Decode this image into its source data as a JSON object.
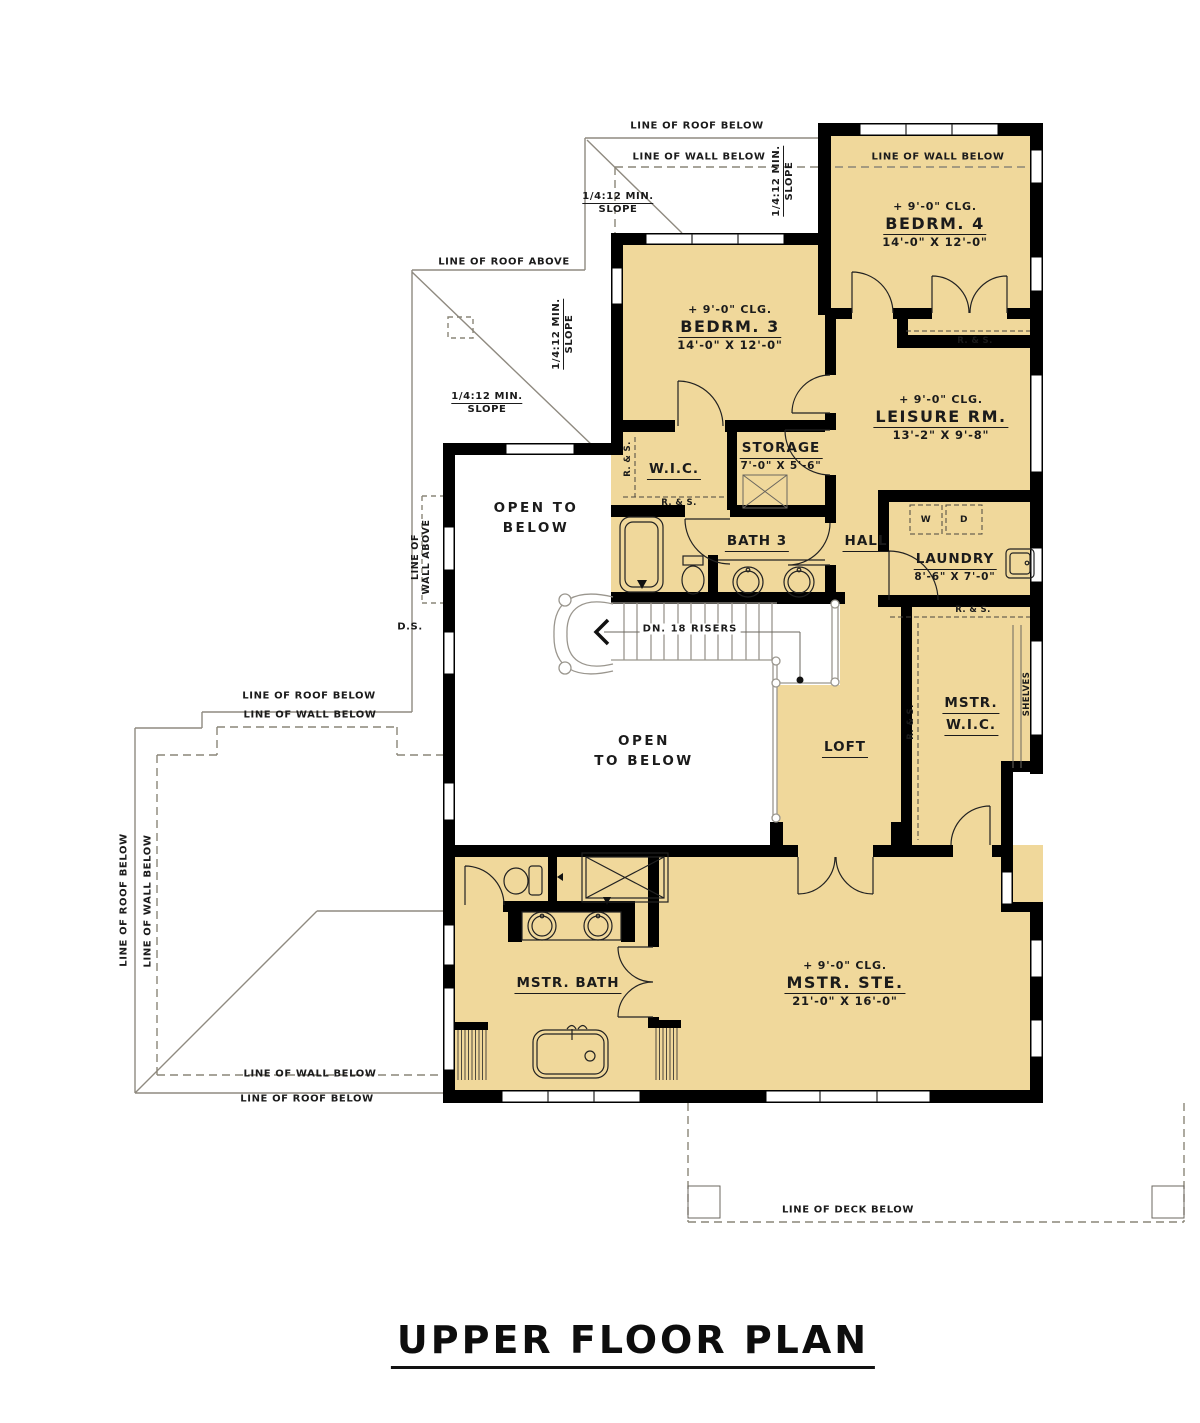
{
  "title": "UPPER FLOOR PLAN",
  "labels": {
    "roof_below": "LINE OF ROOF BELOW",
    "wall_below": "LINE OF WALL BELOW",
    "roof_above": "LINE OF ROOF ABOVE",
    "wall_above_1": "LINE OF",
    "wall_above_2": "WALL ABOVE",
    "deck_below": "LINE OF DECK BELOW",
    "slope_1": "1/4:12 MIN.",
    "slope_2": "SLOPE",
    "downspout": "D.S.",
    "stairs": "DN. 18 RISERS",
    "rod_shelf": "R. & S.",
    "shelves": "SHELVES",
    "washer": "W",
    "dryer": "D",
    "open_below_a1": "OPEN TO",
    "open_below_a2": "BELOW",
    "open_below_b1": "OPEN",
    "open_below_b2": "TO BELOW"
  },
  "rooms": {
    "bedrm4": {
      "ceiling": "+ 9'-0\" CLG.",
      "name": "BEDRM. 4",
      "dims": "14'-0\" X 12'-0\""
    },
    "bedrm3": {
      "ceiling": "+ 9'-0\" CLG.",
      "name": "BEDRM. 3",
      "dims": "14'-0\" X 12'-0\""
    },
    "leisure": {
      "ceiling": "+ 9'-0\" CLG.",
      "name": "LEISURE RM.",
      "dims": "13'-2\" X 9'-8\""
    },
    "wic": {
      "name": "W.I.C."
    },
    "storage": {
      "name": "STORAGE",
      "dims": "7'-0\" X 5'-6\""
    },
    "bath3": {
      "name": "BATH 3"
    },
    "hall": {
      "name": "HALL"
    },
    "laundry": {
      "name": "LAUNDRY",
      "dims": "8'-6\" X 7'-0\""
    },
    "mstr_wic": {
      "name_1": "MSTR.",
      "name_2": "W.I.C."
    },
    "loft": {
      "name": "LOFT"
    },
    "mstr_bath": {
      "name": "MSTR. BATH"
    },
    "mstr_ste": {
      "ceiling": "+ 9'-0\" CLG.",
      "name": "MSTR. STE.",
      "dims": "21'-0\" X 16'-0\""
    }
  },
  "colors": {
    "floor_fill": "#f0d89b",
    "wall": "#000000",
    "roof_line": "#8f8a80",
    "dash": "#8a8578",
    "text": "#1b1b1b",
    "stair": "#9a968e"
  }
}
